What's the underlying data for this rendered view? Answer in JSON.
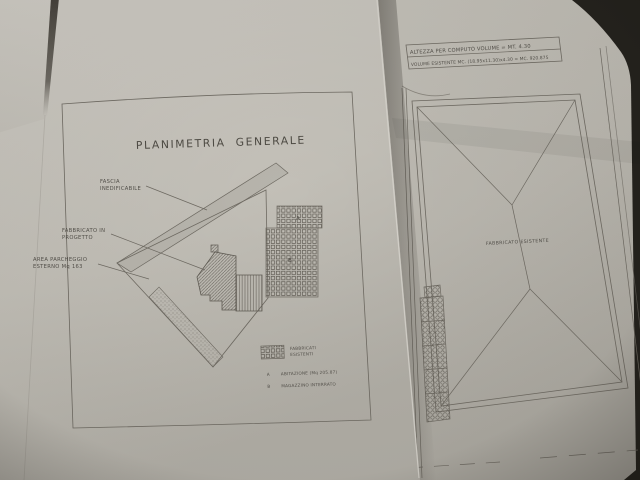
{
  "scene": {
    "background_color": "#24221d",
    "paper_color": "#c6c3bb",
    "line_color": "#6e6a62"
  },
  "left_sheet": {
    "title": "PLANIMETRIA GENERALE",
    "labels": {
      "fascia_line1": "FASCIA",
      "fascia_line2": "INEDIFICABILE",
      "fabbricato_line1": "FABBRICATO IN",
      "fabbricato_line2": "PROGETTO",
      "parcheggio_line1": "AREA PARCHEGGIO",
      "parcheggio_line2": "ESTERNO Mq 163",
      "block_a": "A",
      "block_b": "B"
    },
    "legend": {
      "swatch_line1": "FABBRICATI",
      "swatch_line2": "ESISTENTI",
      "item_a_marker": "A",
      "item_a_label": "ABITAZIONE (Mq 205.87)",
      "item_b_marker": "B",
      "item_b_label": "MAGAZZINO INTERRATO"
    }
  },
  "right_sheet": {
    "notes_line1": "ALTEZZA PER COMPUTO VOLUME = MT. 4.30",
    "notes_line2": "VOLUME ESISTENTE MC. (18.95x11.30)x4.30 = MC. 920.875",
    "roof_label": "FABBRICATO ESISTENTE"
  }
}
